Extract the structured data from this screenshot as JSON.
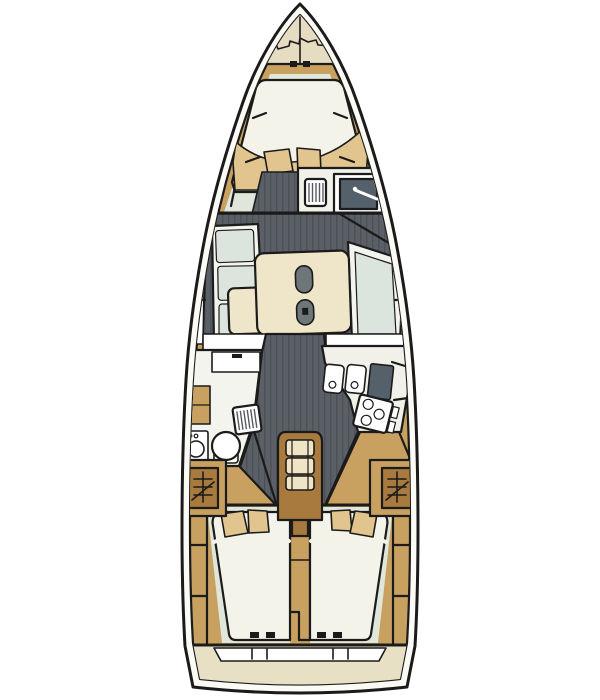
{
  "meta": {
    "width": 600,
    "height": 700
  },
  "colors": {
    "background": "#ffffff",
    "outline": "#1b1b1b",
    "hull_gap": "#fbfaf5",
    "wood": "#c8a161",
    "wood_dark": "#a87a3e",
    "beige": "#e6dcc1",
    "cream": "#efe6c9",
    "mattress": "#f4f3ea",
    "room_white": "#f4f4ee",
    "pale_green": "#dfe6da",
    "cushion": "#dce4de",
    "counter": "#f1f1ea",
    "pure_white": "#ffffff",
    "plank": "#5b5f66",
    "plank_line": "#4b4f56",
    "dark_teal": "#55616a",
    "blanket": "#e2c48e",
    "step_tread": "#efe5c6",
    "transom": "#e8e0c5",
    "capsule": "#6d7678",
    "grate_bar": "#565a60"
  },
  "features": {
    "plan_type": "sailing-yacht-interior-layout",
    "anchor_locker": 1,
    "forward_cabin_pillows": 2,
    "forward_head": {
      "grate": 1,
      "sink": 1,
      "faucet": 1
    },
    "salon": {
      "tables": 1,
      "cup_holder_capsules": 2,
      "settees": 2,
      "windows": 2
    },
    "galley": {
      "sinks": 2,
      "worktop": 1,
      "stove_burners": 3
    },
    "aft_head": {
      "toilet": 1,
      "vanity": 1,
      "shower_grate": 1,
      "washer_unit": 1
    },
    "companionway_steps": 3,
    "hanging_lockers": 2,
    "aft_cabins": 2,
    "aft_cabin_pillows": 4,
    "transom_step_ticks": 4
  }
}
